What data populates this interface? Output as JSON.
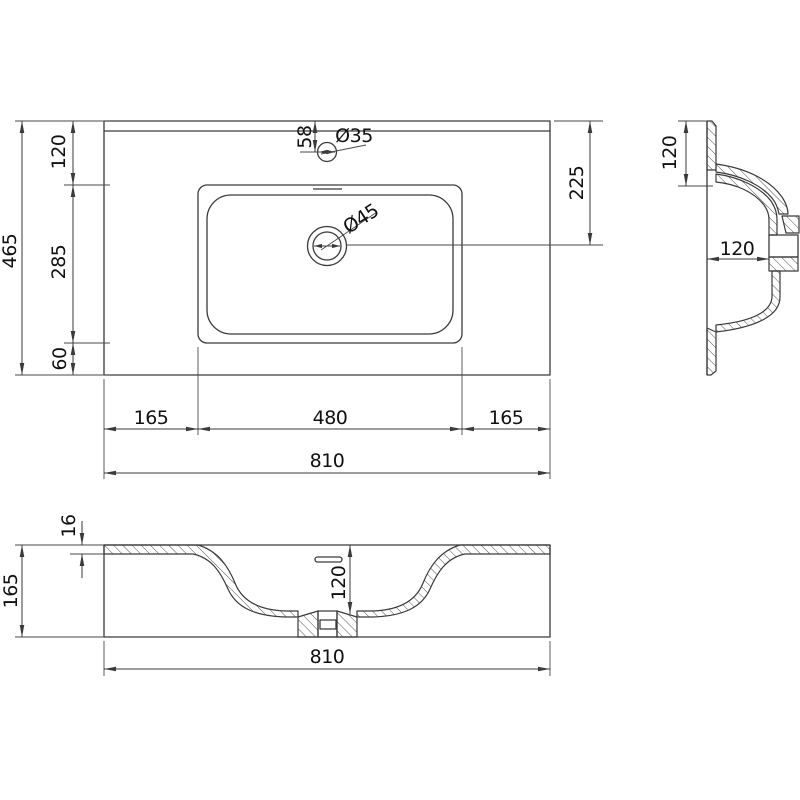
{
  "drawing_type": "washbasin technical dimension drawing",
  "colors": {
    "background": "#ffffff",
    "line": "#3a3a3a",
    "text": "#111111"
  },
  "views": {
    "plan": {
      "overall_depth": "465",
      "back_to_basin": "120",
      "basin_depth": "285",
      "basin_to_front": "60",
      "faucet_offset": "58",
      "faucet_hole_diameter": "Ø35",
      "drain_diameter": "Ø45",
      "back_to_drain": "225",
      "left_to_basin": "165",
      "basin_width": "480",
      "basin_to_right": "165",
      "overall_width": "810"
    },
    "side": {
      "back_depth": "120",
      "bowl_depth": "120"
    },
    "front": {
      "rim_thickness": "16",
      "overall_height": "165",
      "bowl_depth": "120",
      "overall_width": "810"
    }
  }
}
